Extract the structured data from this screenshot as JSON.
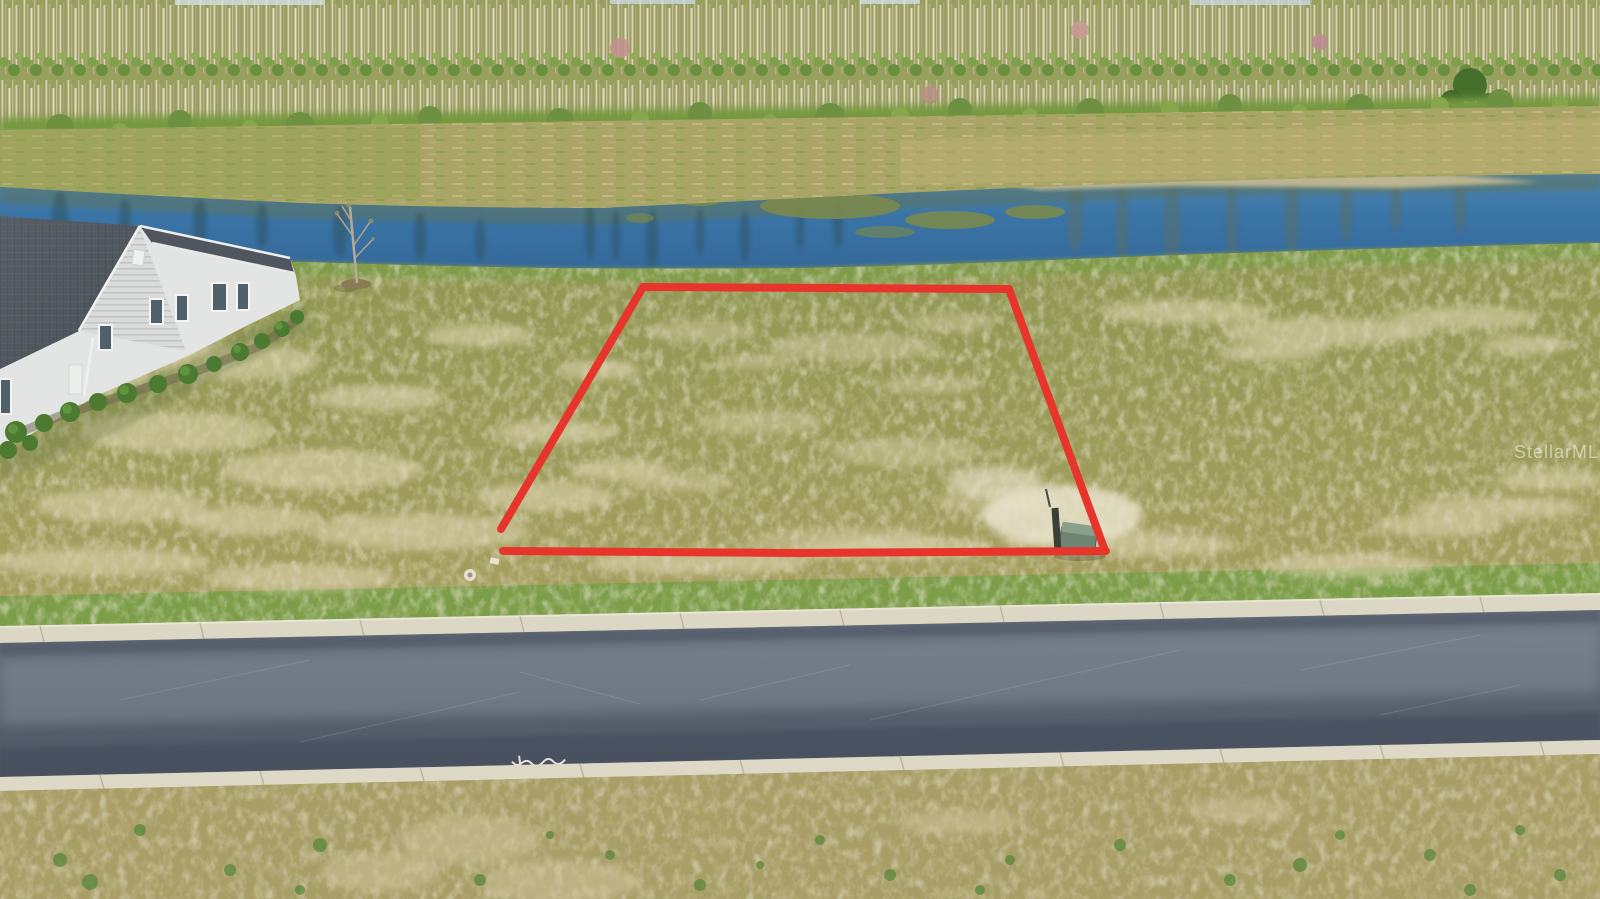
{
  "image": {
    "kind": "aerial drone real-estate photo",
    "description": "Vacant grass lot outlined in red beside a canal and tree line, house at left, asphalt road in foreground",
    "width_px": 1600,
    "height_px": 899
  },
  "watermark": {
    "text": "StellarMLS",
    "color": "#ffffff",
    "opacity": 0.5
  },
  "lot_outline": {
    "color": "#e8352c",
    "stroke_width": 8,
    "sides_points": "501,529 643,287 1009,289 1104,548",
    "bottom_points": "503,551 800,553 1106,551"
  },
  "road_marking": {
    "description": "small white spray-paint scribble on asphalt (illegible)"
  },
  "scene_objects": [
    "bare-trunk tree line with green understory",
    "grassy canal bank",
    "blue canal water with tree reflections and algae patches",
    "sand bar along far shore",
    "vacant lot of patchy yellow-green grass with sandy spots",
    "red lot-boundary outline",
    "single-story gray-roof house with shrubs",
    "young bare sapling with mulch ring",
    "green utility box with post",
    "asphalt road with concrete ribbon curbs",
    "roadside grass strip"
  ],
  "palette": {
    "water": "#3a74a6",
    "field_grass": "#a3a05e",
    "sand_patch": "#dbd2ae",
    "road_asphalt": "#5a6370",
    "curb": "#dcd7c5",
    "roof": "#4f565d",
    "house_wall": "#e3e5e4",
    "shrub_green": "#4c7a30",
    "outline_red": "#e8352c"
  }
}
